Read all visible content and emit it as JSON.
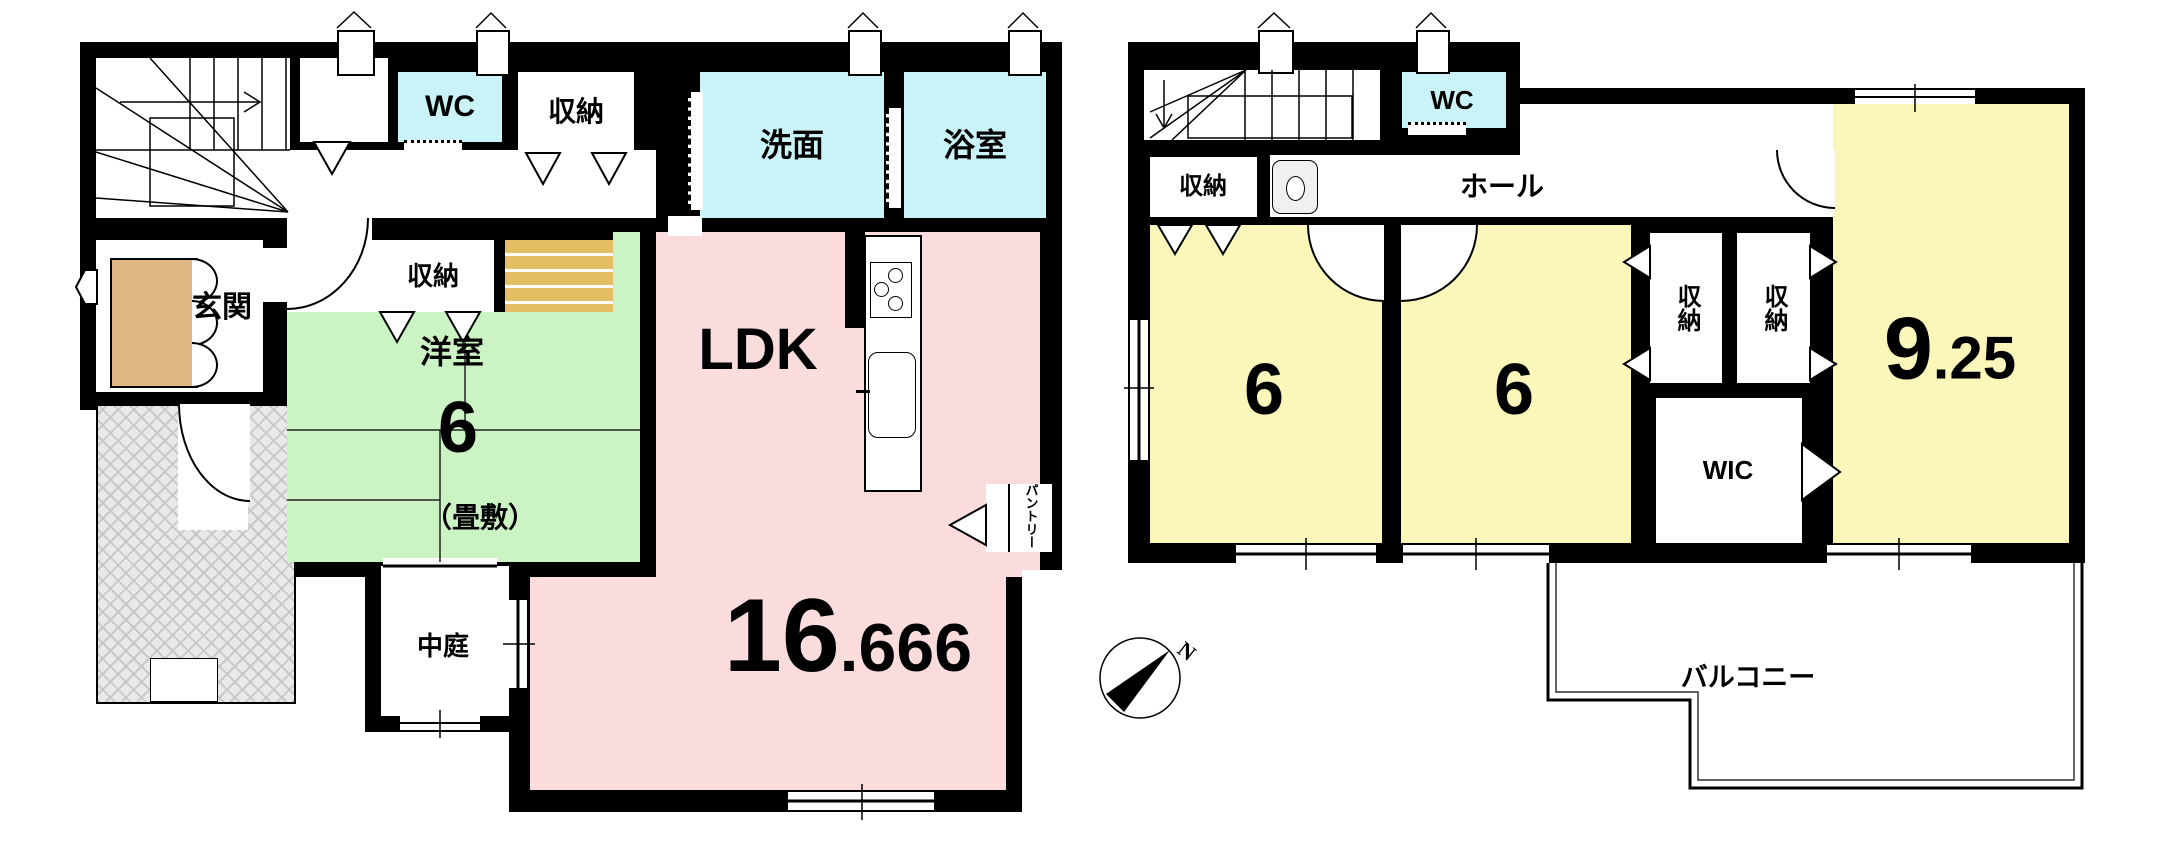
{
  "labels": {
    "f1_wc": "WC",
    "f1_closet_a": "収納",
    "f1_senmen": "洗面",
    "f1_yokushitsu": "浴室",
    "f1_genkan": "玄関",
    "f1_closet_b": "収納",
    "f1_youshitsu": "洋室",
    "f1_youshitsu_size": "6",
    "f1_tatami_note": "（畳敷）",
    "f1_ldk": "LDK",
    "f1_ldk_int": "16",
    "f1_ldk_frac": ".666",
    "f1_nakaniwa": "中庭",
    "f1_pantry": "パントリー",
    "f2_wc": "WC",
    "f2_closet": "収納",
    "f2_hall": "ホール",
    "f2_room1": "6",
    "f2_room2": "6",
    "f2_closet_a": "収納",
    "f2_closet_b": "収納",
    "f2_925_int": "9",
    "f2_925_frac": ".25",
    "f2_wic": "WIC",
    "f2_balcony": "バルコニー",
    "compass_n": "N"
  },
  "colors": {
    "wall": "#000000",
    "wet_area": "#c9f3f7",
    "ldk": "#fadcdc",
    "tatami_room": "#cbf3c4",
    "bedroom": "#fbf7bb",
    "shoe_cabinet": "#dfb785",
    "step": "#e5bd62",
    "porch": "#e9e9e9"
  }
}
